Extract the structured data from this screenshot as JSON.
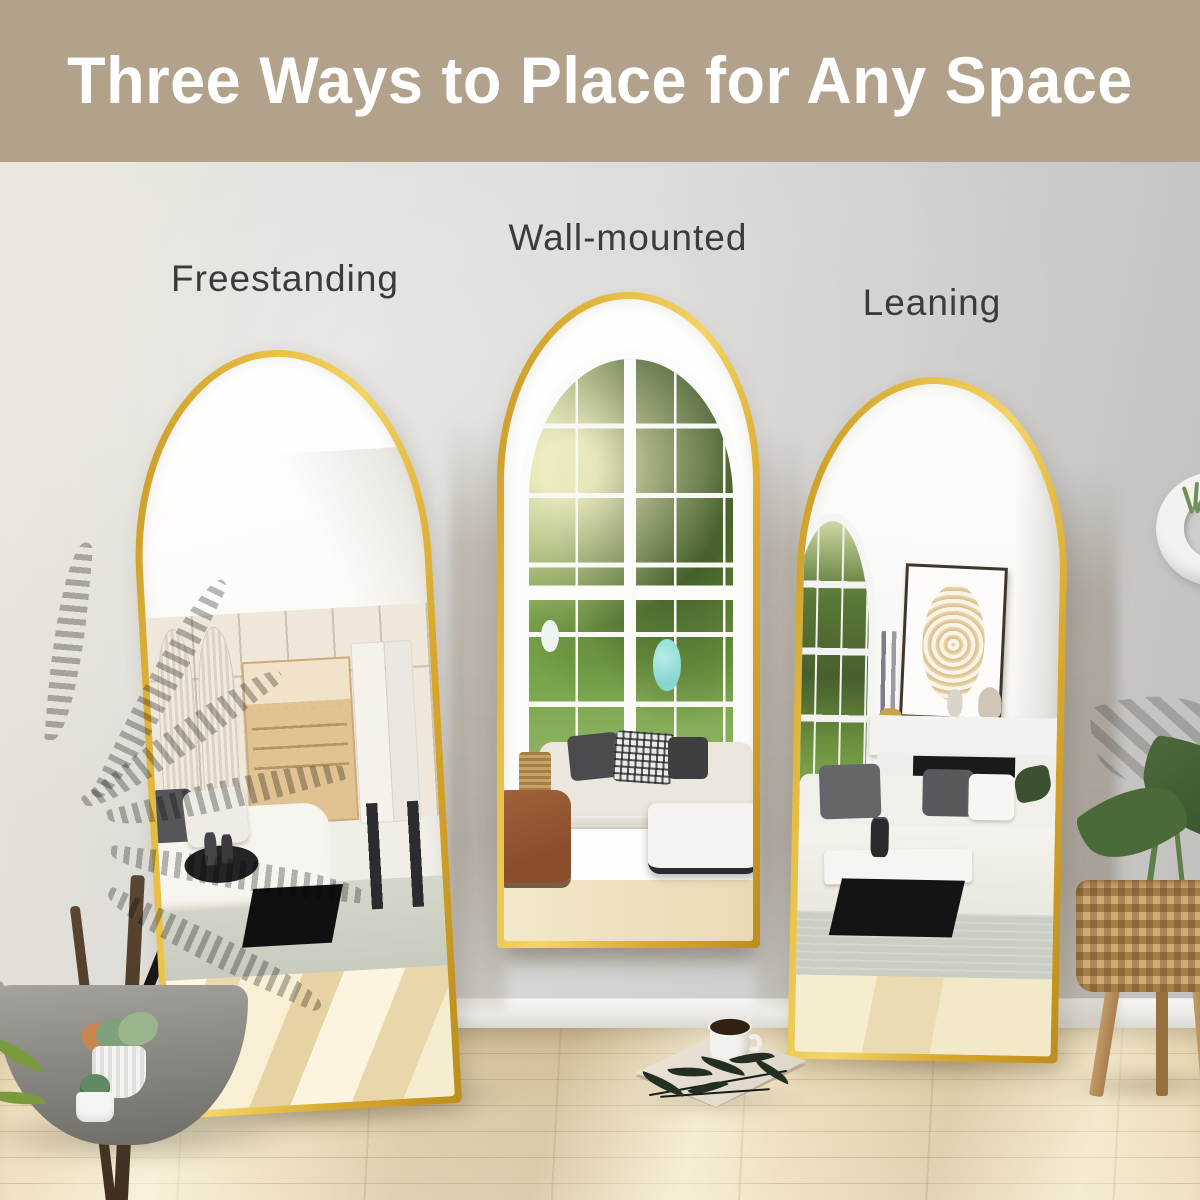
{
  "banner": {
    "title": "Three Ways to Place for Any Space",
    "background_color": "#b2a28b",
    "text_color": "#ffffff"
  },
  "placements": [
    {
      "label": "Freestanding"
    },
    {
      "label": "Wall-mounted"
    },
    {
      "label": "Leaning"
    }
  ],
  "colors": {
    "label_text": "#3b3b3b",
    "mirror_frame_gold": "#e0b13a",
    "wall": "#d8d7d5",
    "floor_wood": "#e9dab6"
  }
}
